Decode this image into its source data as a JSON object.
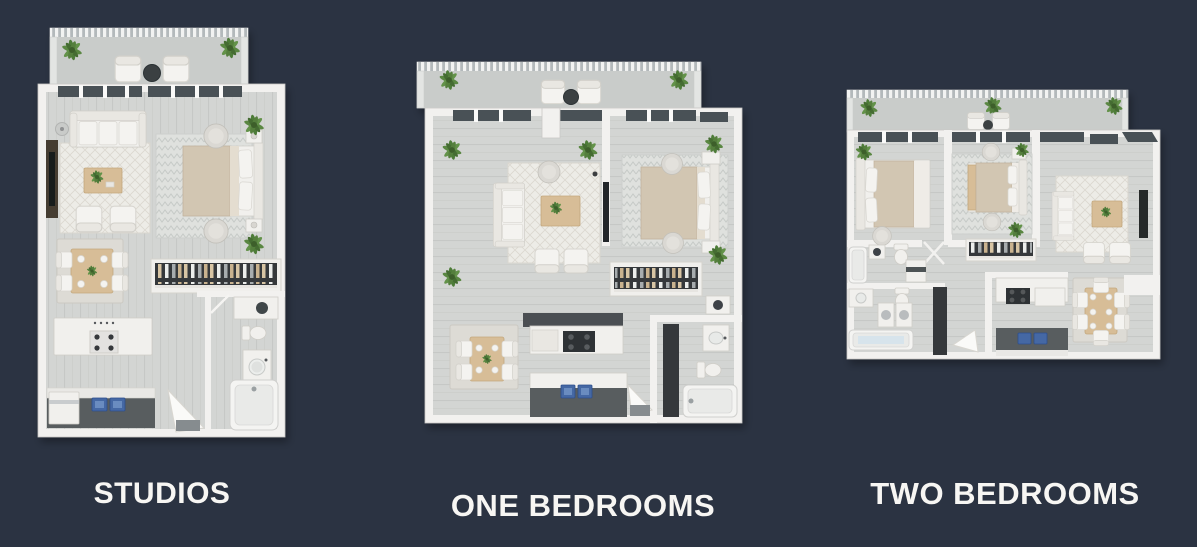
{
  "page": {
    "background_color": "#2b3342"
  },
  "plans": [
    {
      "id": "studios",
      "label": "STUDIOS"
    },
    {
      "id": "one-bedrooms",
      "label": "ONE BEDROOMS"
    },
    {
      "id": "two-bedrooms",
      "label": "TWO BEDROOMS"
    }
  ],
  "palette": {
    "background": "#2b3342",
    "label_text": "#f7f6f3",
    "wall": "#f2f1ef",
    "floor": "#d4d6d4",
    "balcony_floor": "#c9ccca",
    "window_glass": "#4a5156",
    "wood": "#d7bd97",
    "bed_blanket": "#d2c6b2",
    "plant_green": "#4e7b3a",
    "sink_blue": "#4468a4",
    "counter_dark": "#595d5f",
    "closet_dark": "#35383a"
  }
}
